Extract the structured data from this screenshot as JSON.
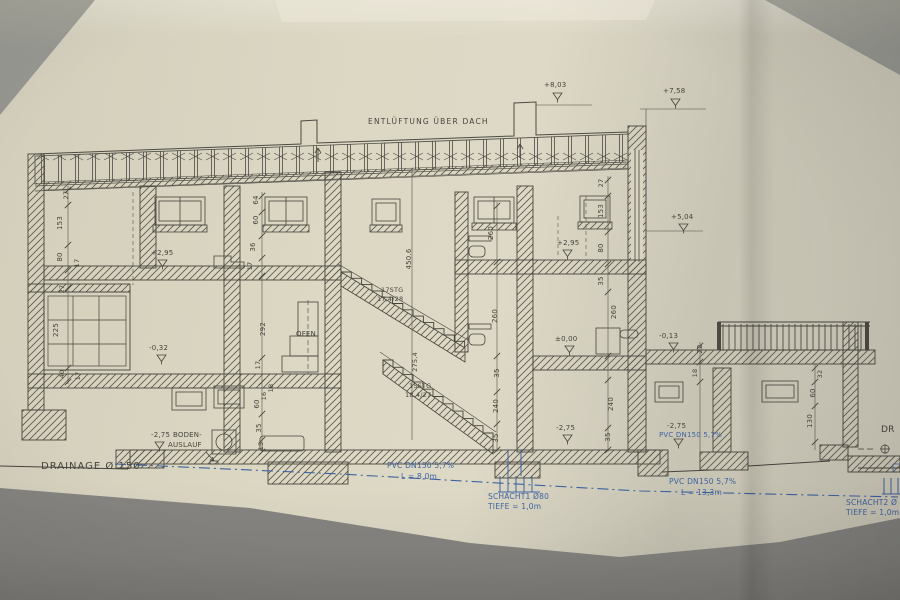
{
  "drawing": {
    "roof_note": "ENTLÜFTUNG ÜBER DACH",
    "levels": {
      "roof_high": "+8,03",
      "roof_low": "+7,58",
      "upper": "+5,04",
      "mid_left": "+2,95",
      "mid_right": "+2,95",
      "ground": "±0,00",
      "terrace": "-0,13",
      "split": "-0,32",
      "basement_left": "-2,75",
      "basement_mid": "-2,75",
      "basement_right": "-2,75"
    },
    "stairs": {
      "upper_count": "17STG",
      "upper_ratio": "17,4/28",
      "lower_count": "15STG",
      "lower_ratio": "18,4/27"
    },
    "rooms": {
      "ofen": "OFEN"
    },
    "dims": {
      "d27t": "27",
      "d153l": "153",
      "d80l": "80",
      "d17l": "17",
      "d27b": "27",
      "d225": "225",
      "d40": "40",
      "d17lb": "17",
      "d64": "64",
      "d60a": "60",
      "d36": "36",
      "d17m": "17",
      "d292": "292",
      "d17o": "17",
      "d18a": "18",
      "d16": "16",
      "d60b": "60",
      "d35k": "35",
      "d15": "15",
      "d4506": "450.6",
      "d2754": "275,4",
      "d260a": "260",
      "d260b": "260",
      "d35a": "35",
      "d240a": "240",
      "d35b": "35",
      "d27r": "27",
      "d153r": "153",
      "d80r": "80",
      "d35r": "35",
      "d260c": "260",
      "d240b": "240",
      "d35c": "35",
      "d22": "22",
      "d18t": "18",
      "d32": "32",
      "d60t": "60",
      "d130": "130"
    },
    "drainage": {
      "main": "DRAINAGE  Ø 150",
      "boden1": "BODEN-",
      "boden2": "AUSLAUF",
      "pvc1": "PVC DN150  5,7%",
      "pvc1_len": "L = 8,0m",
      "schacht1": "SCHACHT1  Ø80",
      "schacht1_depth": "TIEFE = 1,0m",
      "pvc2": "PVC DN150  5,7%",
      "pvc3": "PVC DN150  5,7%",
      "pvc3_len": "L = 13,3m",
      "schacht2": "SCHACHT2  Ø",
      "schacht2_depth": "TIEFE = 1,0m",
      "right_cut": "DR"
    },
    "colors": {
      "paper": "#d9d4c1",
      "ink": "#46443c",
      "blue": "#3f63a0",
      "table": "#8f8e8a"
    }
  }
}
